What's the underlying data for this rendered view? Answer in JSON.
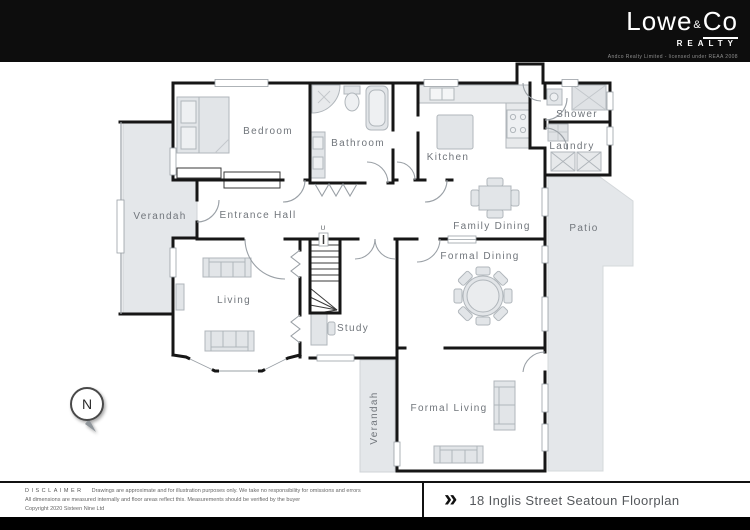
{
  "header": {
    "brand_word1": "Lowe",
    "brand_amp": "&",
    "brand_word2": "Co",
    "brand_sub": "REALTY",
    "license": "Andco Realty Limited - licensed under REAA 2008"
  },
  "plan": {
    "rooms": [
      {
        "label": "Bedroom"
      },
      {
        "label": "Bathroom"
      },
      {
        "label": "Kitchen"
      },
      {
        "label": "Shower"
      },
      {
        "label": "Laundry"
      },
      {
        "label": "Verandah"
      },
      {
        "label": "Entrance Hall"
      },
      {
        "label": "Family Dining"
      },
      {
        "label": "Patio"
      },
      {
        "label": "Formal Dining"
      },
      {
        "label": "Living"
      },
      {
        "label": "Study"
      },
      {
        "label": "Formal Living"
      },
      {
        "label": "Verandah"
      }
    ],
    "stairs_up_label": "U",
    "compass_letter": "N",
    "colors": {
      "outdoor_fill": "#e4e7ea",
      "wall": "#161616",
      "furniture_fill": "#e2e5e8",
      "furniture_stroke": "#b0b6bb",
      "label": "#70757b"
    }
  },
  "footer": {
    "disclaimer_title": "DISCLAIMER",
    "disclaimer_line1": "Drawings are approximate and for illustration purposes only. We take no responsibility for omissions and errors",
    "disclaimer_line2": "All dimensions are measured internally and floor areas reflect this. Measurements should be verified by the buyer",
    "disclaimer_line3": "Copyright 2020 Sixteen Nine Ltd",
    "chevron": "»",
    "title": "18 Inglis Street Seatoun Floorplan"
  }
}
